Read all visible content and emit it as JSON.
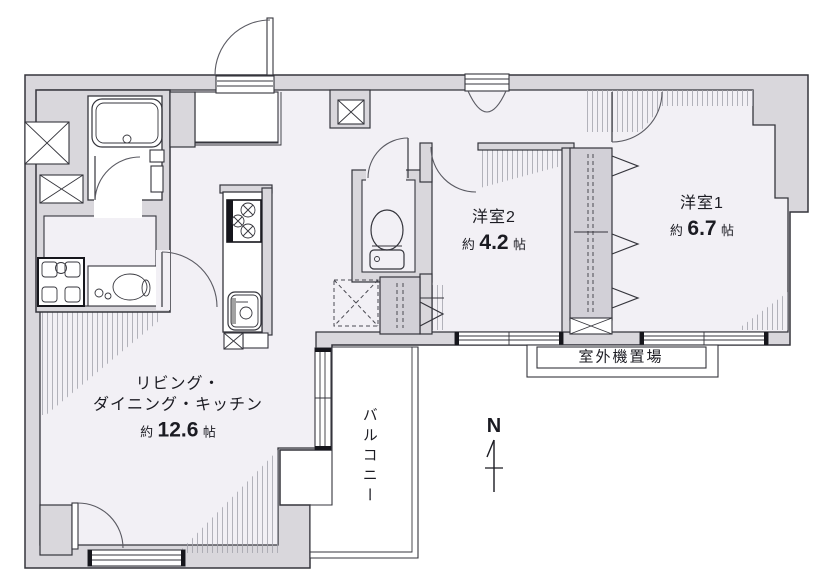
{
  "floorplan": {
    "rooms": {
      "ldk": {
        "name_line1": "リビング・",
        "name_line2": "ダイニング・キッチン",
        "area_prefix": "約",
        "area_value": "12.6",
        "area_unit": "帖"
      },
      "bedroom2": {
        "name": "洋室2",
        "area_prefix": "約",
        "area_value": "4.2",
        "area_unit": "帖"
      },
      "bedroom1": {
        "name": "洋室1",
        "area_prefix": "約",
        "area_value": "6.7",
        "area_unit": "帖"
      },
      "balcony": {
        "name": "バルコニー"
      },
      "outdoor_unit": {
        "name": "室外機置場"
      }
    },
    "compass": {
      "label": "N"
    },
    "colors": {
      "wall_fill": "#d9d7dc",
      "room_fill": "#f2f0f5",
      "closet_fill": "#d2d0d7",
      "outline": "#35353c",
      "hatch": "#a2a2ab"
    }
  }
}
